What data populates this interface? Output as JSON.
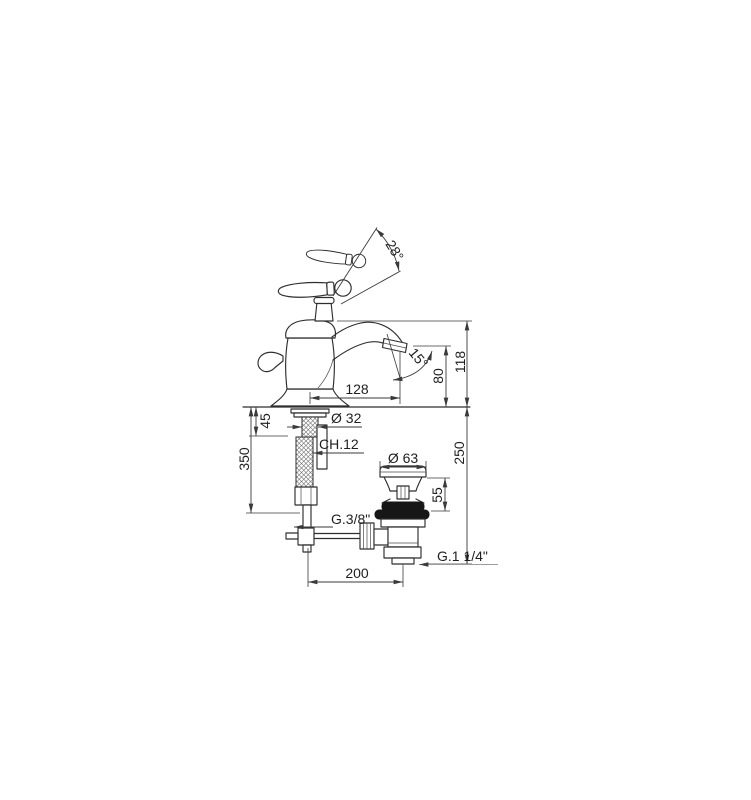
{
  "page": {
    "background_color": "#ffffff"
  },
  "drawing": {
    "type": "technical-dimension-drawing",
    "subject": "single-lever basin mixer tap with pop-up waste, side elevation",
    "colors": {
      "line": "#2e2e2e",
      "dimension_line": "#3a3a3a",
      "light_leader": "#9b9b9b",
      "text": "#1f1f1f",
      "gasket_fill": "#161616",
      "background": "#ffffff"
    },
    "labels": {
      "handle_arc_angle": "28°",
      "spout_tilt_angle": "15°",
      "body_height": "118",
      "outlet_height": "80",
      "spout_reach": "128",
      "shank_diameter": "Ø 32",
      "deck_clamp_thickness": "45",
      "wrench_size": "CH.12",
      "hose_drop": "350",
      "below_deck_depth": "250",
      "waste_flange_diameter": "Ø 63",
      "waste_head_height": "55",
      "inlet_thread": "G.3/8\"",
      "waste_thread": "G.1 1/4\"",
      "popup_rod_offset": "200"
    }
  }
}
